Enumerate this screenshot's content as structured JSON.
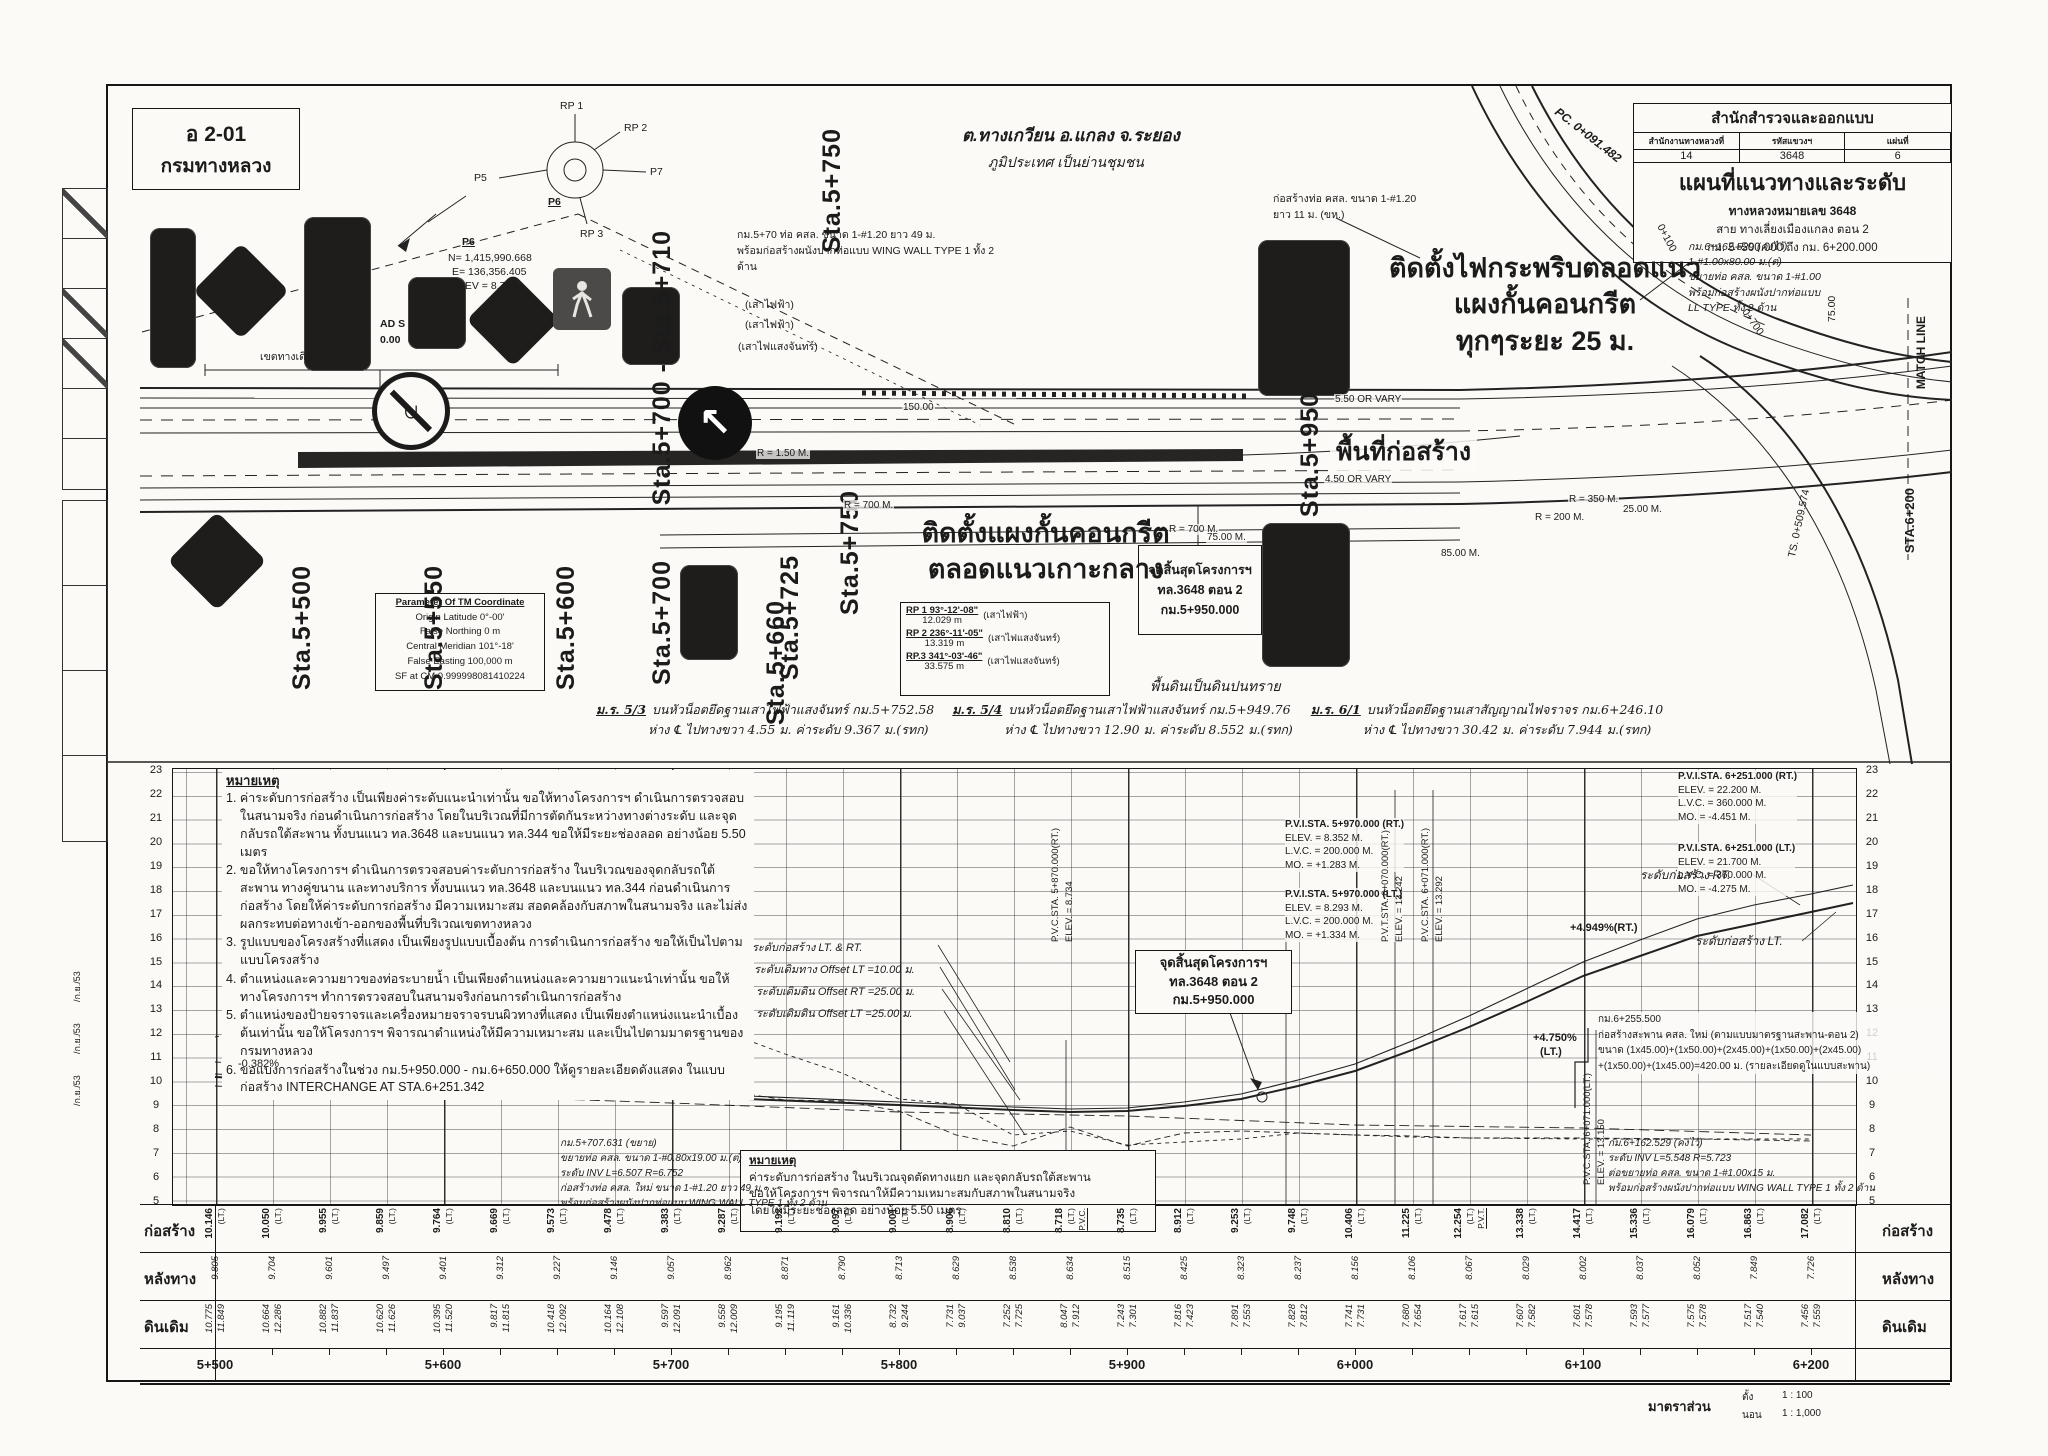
{
  "code_box": {
    "code": "อ 2-01",
    "agency": "กรมทางหลวง"
  },
  "title_block": {
    "bureau": "สำนักสำรวจและออกแบบ",
    "cols": [
      {
        "label": "สำนักงานทางหลวงที่",
        "value": "14"
      },
      {
        "label": "รหัสแขวงฯ",
        "value": "3648"
      },
      {
        "label": "แผ่นที่",
        "value": "6"
      }
    ],
    "title": "แผนที่แนวทางและระดับ",
    "sub1": "ทางหลวงหมายเลข 3648",
    "sub2": "สาย ทางเลี่ยงเมืองแกลง ตอน 2",
    "sub3": "กม. 5+500.000 ถึง กม. 6+200.000"
  },
  "plan": {
    "location1": "ต.ทางเกวียน อ.แกลง จ.ระยอง",
    "location2": "ภูมิประเทศ เป็นย่านชุมชน",
    "stations": [
      "Sta.5+500",
      "Sta.5+550",
      "Sta.5+600",
      "Sta.5+660",
      "Sta.5+700 - Sta.5+710",
      "Sta.5+750",
      "Sta.5+750",
      "Sta.5+725",
      "Sta.5+700",
      "Sta.5+950"
    ],
    "sta_6200": "STA.6+200",
    "match_line": "MATCH LINE",
    "construction_area": "พื้นที่ก่อสร้าง",
    "flashing_note": [
      "ติดตั้งไฟกระพริบตลอดแนว",
      "แผงกั้นคอนกรีต",
      "ทุกๆระยะ 25 ม."
    ],
    "barrier_note": [
      "ติดตั้งแผงกั้นคอนกรีต",
      "ตลอดแนวเกาะกลาง"
    ],
    "soil_note": "พื้นดินเป็นดินปนทราย",
    "end_project_box": [
      "จุดสิ้นสุดโครงการฯ",
      "ทล.3648 ตอน 2",
      "กม.5+950.000"
    ],
    "existing_row": "เขตทางเดิม",
    "survey_point": {
      "id": "P6",
      "n": "N= 1,415,990.668",
      "e": "E= 136,356.405",
      "elev": "ELEV = 8.763"
    },
    "compass": {
      "rp1": "RP 1",
      "rp2": "RP 2",
      "rp3": "RP 3",
      "p5": "P5",
      "p6": "P6",
      "p7": "P7"
    },
    "ad": {
      "l1": "AD S",
      "l2": "0.00"
    },
    "rp_table": [
      {
        "bearing": "RP 1  93°-12'-08\"",
        "dist": "12.029 m",
        "ref": "(เสาไฟฟ้า)"
      },
      {
        "bearing": "RP 2  236°-11'-05\"",
        "dist": "13.319 m",
        "ref": "(เสาไฟแสงจันทร์)"
      },
      {
        "bearing": "RP.3  341°-03'-46\"",
        "dist": "33.575 m",
        "ref": "(เสาไฟแสงจันทร์)"
      }
    ],
    "tm_box": {
      "title": "Parameter Of TM  Coordinate",
      "rows": [
        "Origin Latitude  0°-00'",
        "False Northing  0 m",
        "Central Meridian  101°-18'",
        "False Easting  100,000 m",
        "SF  at  CM  0.999998081410224"
      ]
    },
    "culvert_top": [
      "กม.5+70  ท่อ คสล. ขนาด 1-#1.20 ยาว 49 ม.",
      "พร้อมก่อสร้างผนังปากท่อแบบ WING WALL TYPE 1 ทั้ง 2 ด้าน"
    ],
    "poles": [
      "(เสาไฟฟ้า)",
      "(เสาไฟฟ้า)",
      "(เสาไฟแสงจันทร์)"
    ],
    "culvert_tr": [
      "ก่อสร้างท่อ คสล. ขนาด 1-#1.20",
      "ยาว 11 ม. (ขห.)"
    ],
    "culvert_right": [
      "กม.6+162.529 (คงไว้)",
      "1-#1.00x80.00 ม.(ต่)",
      "ขยายท่อ คสล. ขนาด 1-#1.00",
      "พร้อมก่อสร้างผนังปากท่อแบบ",
      "LL TYPE ทั้ง 2 ด้าน"
    ],
    "pc_label": "PC. 0+091.482",
    "ts_label": "TS. 0+509.574",
    "k100": "0+100",
    "k700": "0+700",
    "v75": "75.00",
    "dims": {
      "d150": "150.00",
      "r150": "R = 1.50 M.",
      "r700a": "R = 700 M.",
      "r700b": "R = 700 M.",
      "vary_top": "5.50 OR VARY",
      "vary_bot": "4.50 OR VARY",
      "m75": "75.00 M.",
      "m85": "85.00 M.",
      "m25": "25.00 M.",
      "r350": "R = 350 M.",
      "r200": "R = 200 M."
    },
    "benchmarks": [
      {
        "id": "ม.ร. 5/3",
        "desc": "บนหัวน็อตยึดฐานเสาไฟฟ้าแสงจันทร์  กม.5+752.58",
        "detail": "ห่าง ℄ ไปทางขวา 4.55 ม.  ค่าระดับ  9.367  ม.(รทก)"
      },
      {
        "id": "ม.ร. 5/4",
        "desc": "บนหัวน็อตยึดฐานเสาไฟฟ้าแสงจันทร์  กม.5+949.76",
        "detail": "ห่าง ℄ ไปทางขวา 12.90 ม.  ค่าระดับ  8.552  ม.(รทก)"
      },
      {
        "id": "ม.ร. 6/1",
        "desc": "บนหัวน็อตยึดฐานเสาสัญญาณไฟจราจร  กม.6+246.10",
        "detail": "ห่าง ℄ ไปทางขวา 30.42 ม.  ค่าระดับ  7.944  ม.(รทก)"
      }
    ],
    "stamps": [
      "/ก.ย./53",
      "/ก.ย./53",
      "/ก.ย./53"
    ]
  },
  "profile": {
    "notes_title": "หมายเหตุ",
    "notes": [
      "1. ค่าระดับการก่อสร้าง เป็นเพียงค่าระดับแนะนำเท่านั้น ขอให้ทางโครงการฯ ดำเนินการตรวจสอบในสนามจริง ก่อนดำเนินการก่อสร้าง โดยในบริเวณที่มีการตัดกันระหว่างทางต่างระดับ และจุดกลับรถใต้สะพาน ทั้งบนแนว ทล.3648 และบนแนว ทล.344 ขอให้มีระยะช่องลอด อย่างน้อย 5.50 เมตร",
      "2. ขอให้ทางโครงการฯ ดำเนินการตรวจสอบค่าระดับการก่อสร้าง ในบริเวณของจุดกลับรถใต้สะพาน ทางคู่ขนาน และทางบริการ ทั้งบนแนว ทล.3648 และบนแนว ทล.344 ก่อนดำเนินการก่อสร้าง โดยให้ค่าระดับการก่อสร้าง มีความเหมาะสม สอดคล้องกับสภาพในสนามจริง และไม่ส่งผลกระทบต่อทางเข้า-ออกของพื้นที่บริเวณเขตทางหลวง",
      "3. รูปแบบของโครงสร้างที่แสดง เป็นเพียงรูปแบบเบื้องต้น การดำเนินการก่อสร้าง ขอให้เป็นไปตามแบบโครงสร้าง",
      "4. ตำแหน่งและความยาวของท่อระบายน้ำ เป็นเพียงตำแหน่งและความยาวแนะนำเท่านั้น ขอให้ทางโครงการฯ ทำการตรวจสอบในสนามจริงก่อนการดำเนินการก่อสร้าง",
      "5. ตำแหน่งของป้ายจราจรและเครื่องหมายจราจรบนผิวทางที่แสดง เป็นเพียงตำแหน่งแนะนำเบื้องต้นเท่านั้น ขอให้โครงการฯ พิจารณาตำแหน่งให้มีความเหมาะสม และเป็นไปตามมาตรฐานของกรมทางหลวง",
      "6. ขอแบ่งการก่อสร้างในช่วง กม.5+950.000 - กม.6+650.000 ให้ดูรายละเอียดดังแสดง ในแบบก่อสร้าง INTERCHANGE AT STA.6+251.342"
    ],
    "leader_labels": [
      "ระดับก่อสร้าง LT. & RT.",
      "ระดับเดิมทาง Offset LT =10.00 ม.",
      "ระดับเดิมดิน Offset RT =25.00 ม.",
      "ระดับเดิมดิน Offset LT =25.00 ม."
    ],
    "elevations": [
      "23",
      "22",
      "21",
      "20",
      "19",
      "18",
      "17",
      "16",
      "15",
      "14",
      "13",
      "12",
      "11",
      "10",
      "9",
      "8",
      "7",
      "6",
      "5"
    ],
    "pvi": [
      {
        "sta": "P.V.I.STA.  5+970.000 (RT.)",
        "rows": [
          "ELEV.   =  8.352      M.",
          "L.V.C.  =  200.000  M.",
          "MO.     =  +1.283    M."
        ]
      },
      {
        "sta": "P.V.I.STA.  5+970.000 (LT.)",
        "rows": [
          "ELEV.   =  8.293      M.",
          "L.V.C.  =  200.000  M.",
          "MO.     =  +1.334    M."
        ]
      },
      {
        "sta": "P.V.I.STA.  6+251.000 (RT.)",
        "rows": [
          "ELEV.   =  22.200    M.",
          "L.V.C.  =  360.000  M.",
          "MO.     =  -4.451     M."
        ]
      },
      {
        "sta": "P.V.I.STA.  6+251.000 (LT.)",
        "rows": [
          "ELEV.   =  21.700    M.",
          "L.V.C.  =  360.000  M.",
          "MO.     =  -4.275     M."
        ]
      }
    ],
    "vlabels": [
      {
        "sta": "P.V.C.STA. 5+870.000(RT.)",
        "elev": "ELEV. = 8.734"
      },
      {
        "sta": "P.V.T.STA. 6+070.000(RT.)",
        "elev": "ELEV. = 13.242"
      },
      {
        "sta": "P.V.C.STA. 6+071.000(RT.)",
        "elev": "ELEV. = 13.292"
      },
      {
        "sta": "P.V.C.STA. 6+071.000(LT.)",
        "elev": "ELEV. = 13.150"
      }
    ],
    "slopes": {
      "left": "-0.382%",
      "rt": "+4.949%(RT.)",
      "lt1": "+4.750%",
      "lt2": "(LT.)"
    },
    "grade_rt": "ระดับก่อสร้าง RT.",
    "grade_lt": "ระดับก่อสร้าง LT.",
    "end_box": [
      "จุดสิ้นสุดโครงการฯ",
      "ทล.3648  ตอน 2",
      "กม.5+950.000"
    ],
    "bridge_note": [
      "กม.6+255.500",
      "ก่อสร้างสะพาน คสล. ใหม่ (ตามแบบมาตรฐานสะพาน-ตอน 2)",
      "ขนาด (1x45.00)+(1x50.00)+(2x45.00)+(1x50.00)+(2x45.00)",
      "+(1x50.00)+(1x45.00)=420.00 ม. (รายละเอียดดูในแบบสะพาน)"
    ],
    "culvert_left": [
      "กม.5+707.631 (ขยาย)",
      "ขยายท่อ คสล. ขนาด 1-#0.80x19.00 ม.(ต่)",
      "ระดับ INV  L=6.507  R=6.752",
      "ก่อสร้างท่อ คสล. ใหม่ ขนาด 1-#1.20 ยาว 49 ม.",
      "พร้อมก่อสร้างผนังปากท่อแบบ WING WALL TYPE 1 ทั้ง 2 ด้าน"
    ],
    "culvert_right": [
      "กม.6+162.529 (คงไว้)",
      "ระดับ INV  L=5.548  R=5.723",
      "ต่อขยายท่อ คสล. ขนาด 1-#1.00x15 ม.",
      "พร้อมก่อสร้างผนังปากท่อแบบ WING WALL TYPE 1 ทั้ง 2 ด้าน"
    ],
    "note_box": {
      "title": "หมายเหตุ",
      "lines": [
        "ค่าระดับการก่อสร้าง ในบริเวณจุดตัดทางแยก และจุดกลับรถใต้สะพาน",
        "ขอให้โครงการฯ พิจารณาให้มีความเหมาะสมกับสภาพในสนามจริง",
        "โดยให้มีระยะช่องลอด อย่างน้อย 5.50 เมตร"
      ]
    }
  },
  "table": {
    "row_labels": [
      "ก่อสร้าง",
      "หลังทาง",
      "ดินเดิม"
    ],
    "stations": [
      "5+500",
      "5+600",
      "5+700",
      "5+800",
      "5+900",
      "6+000",
      "6+100",
      "6+200"
    ],
    "columns": [
      {
        "c": "10.146",
        "s": "(LT.)",
        "m": "",
        "r": "9.805",
        "g1": "10.775",
        "g2": "11.849"
      },
      {
        "c": "10.050",
        "s": "(LT.)",
        "m": "",
        "r": "9.704",
        "g1": "10.664",
        "g2": "12.286"
      },
      {
        "c": "9.955",
        "s": "(LT.)",
        "m": "",
        "r": "9.601",
        "g1": "10.882",
        "g2": "11.837"
      },
      {
        "c": "9.859",
        "s": "(LT.)",
        "m": "",
        "r": "9.497",
        "g1": "10.620",
        "g2": "11.626"
      },
      {
        "c": "9.764",
        "s": "(LT.)",
        "m": "",
        "r": "9.401",
        "g1": "10.395",
        "g2": "11.520"
      },
      {
        "c": "9.669",
        "s": "(LT.)",
        "m": "",
        "r": "9.312",
        "g1": "9.817",
        "g2": "11.815"
      },
      {
        "c": "9.573",
        "s": "(LT.)",
        "m": "",
        "r": "9.227",
        "g1": "10.418",
        "g2": "12.092"
      },
      {
        "c": "9.478",
        "s": "(LT.)",
        "m": "",
        "r": "9.146",
        "g1": "10.164",
        "g2": "12.108"
      },
      {
        "c": "9.383",
        "s": "(LT.)",
        "m": "",
        "r": "9.057",
        "g1": "9.597",
        "g2": "12.091"
      },
      {
        "c": "9.287",
        "s": "(LT.)",
        "m": "",
        "r": "8.962",
        "g1": "9.558",
        "g2": "12.009"
      },
      {
        "c": "9.192",
        "s": "(LT.)",
        "m": "",
        "r": "8.871",
        "g1": "9.195",
        "g2": "11.119"
      },
      {
        "c": "9.097",
        "s": "(LT.)",
        "m": "",
        "r": "8.790",
        "g1": "9.161",
        "g2": "10.336"
      },
      {
        "c": "9.001",
        "s": "(LT.)",
        "m": "",
        "r": "8.713",
        "g1": "8.732",
        "g2": "9.244"
      },
      {
        "c": "8.906",
        "s": "(LT.)",
        "m": "",
        "r": "8.629",
        "g1": "7.731",
        "g2": "9.037"
      },
      {
        "c": "8.810",
        "s": "(LT.)",
        "m": "",
        "r": "8.538",
        "g1": "7.252",
        "g2": "7.725"
      },
      {
        "c": "8.718",
        "s": "(LT.)",
        "m": "P.V.C.",
        "r": "8.634",
        "g1": "8.047",
        "g2": "7.912"
      },
      {
        "c": "8.735",
        "s": "(LT.)",
        "m": "",
        "r": "8.515",
        "g1": "7.243",
        "g2": "7.301"
      },
      {
        "c": "8.912",
        "s": "(LT.)",
        "m": "",
        "r": "8.425",
        "g1": "7.816",
        "g2": "7.423"
      },
      {
        "c": "9.253",
        "s": "(LT.)",
        "m": "",
        "r": "8.323",
        "g1": "7.891",
        "g2": "7.553"
      },
      {
        "c": "9.748",
        "s": "(LT.)",
        "m": "",
        "r": "8.237",
        "g1": "7.828",
        "g2": "7.812"
      },
      {
        "c": "10.406",
        "s": "(LT.)",
        "m": "",
        "r": "8.156",
        "g1": "7.741",
        "g2": "7.731"
      },
      {
        "c": "11.225",
        "s": "(LT.)",
        "m": "",
        "r": "8.106",
        "g1": "7.680",
        "g2": "7.654"
      },
      {
        "c": "12.254",
        "s": "(LT.)",
        "m": "P.V.T.",
        "r": "8.067",
        "g1": "7.617",
        "g2": "7.615"
      },
      {
        "c": "13.338",
        "s": "(LT.)",
        "m": "",
        "r": "8.029",
        "g1": "7.607",
        "g2": "7.582"
      },
      {
        "c": "14.417",
        "s": "(LT.)",
        "m": "",
        "r": "8.002",
        "g1": "7.601",
        "g2": "7.578"
      },
      {
        "c": "15.336",
        "s": "(LT.)",
        "m": "",
        "r": "8.037",
        "g1": "7.593",
        "g2": "7.577"
      },
      {
        "c": "16.079",
        "s": "(LT.)",
        "m": "",
        "r": "8.052",
        "g1": "7.575",
        "g2": "7.578"
      },
      {
        "c": "16.863",
        "s": "(LT.)",
        "m": "",
        "r": "7.849",
        "g1": "7.517",
        "g2": "7.540"
      },
      {
        "c": "17.082",
        "s": "(LT.)",
        "m": "",
        "r": "7.726",
        "g1": "7.456",
        "g2": "7.559"
      }
    ]
  },
  "scale": {
    "label": "มาตราส่วน",
    "v_label": "ตั้ง",
    "v_value": "1  :  100",
    "h_label": "นอน",
    "h_value": "1  :  1,000"
  }
}
